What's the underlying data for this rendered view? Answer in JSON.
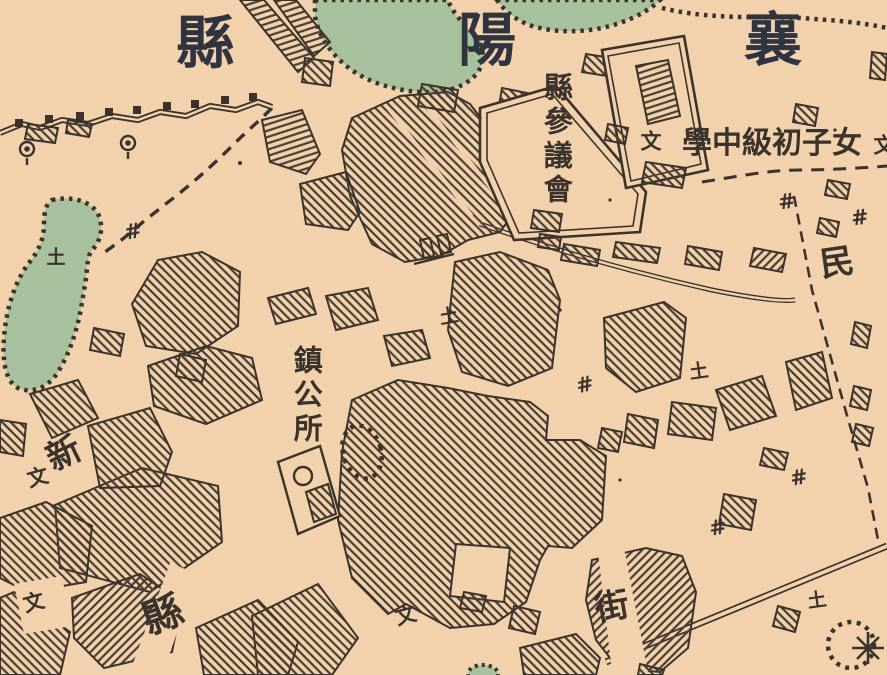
{
  "colors": {
    "paper": "#f1d2ad",
    "water": "#a8c19d",
    "ink": "#3b332b",
    "title_ink": "#2f3440",
    "hatch": "#4a3d33"
  },
  "title": {
    "text": "襄陽縣",
    "note": "map region title, read right-to-left across the top",
    "characters": [
      {
        "char": "襄",
        "x": 773,
        "y": 40,
        "size": 58,
        "rotate": 0
      },
      {
        "char": "陽",
        "x": 487,
        "y": 40,
        "size": 58,
        "rotate": 0
      },
      {
        "char": "縣",
        "x": 205,
        "y": 43,
        "size": 58,
        "rotate": 0
      }
    ]
  },
  "labels": [
    {
      "name": "label-county-council",
      "text": "縣參議會",
      "x": 556,
      "y": 140,
      "size": 29,
      "rotate": 0,
      "vertical": true,
      "direction": "ttb"
    },
    {
      "name": "label-town-hall",
      "text": "鎮公所",
      "x": 306,
      "y": 396,
      "size": 29,
      "rotate": 0,
      "vertical": true,
      "direction": "ttb"
    },
    {
      "name": "label-girls-school",
      "text": "女子初級中學",
      "x": 772,
      "y": 144,
      "size": 30,
      "rotate": 0,
      "vertical": false,
      "direction": "rtl"
    },
    {
      "name": "label-min",
      "text": "民",
      "x": 837,
      "y": 263,
      "size": 34,
      "rotate": -8,
      "vertical": false,
      "direction": "ltr"
    },
    {
      "name": "label-xin",
      "text": "新",
      "x": 64,
      "y": 454,
      "size": 34,
      "rotate": -26,
      "vertical": false,
      "direction": "ltr"
    },
    {
      "name": "label-county-south",
      "text": "縣",
      "x": 163,
      "y": 616,
      "size": 40,
      "rotate": -20,
      "vertical": false,
      "direction": "ltr"
    },
    {
      "name": "label-street",
      "text": "街",
      "x": 612,
      "y": 607,
      "size": 34,
      "rotate": -10,
      "vertical": false,
      "direction": "ltr"
    }
  ],
  "marker_groups": [
    {
      "name": "well-marker",
      "glyph": "#",
      "size": 21,
      "items": [
        {
          "x": 133,
          "y": 232,
          "rotate": -10
        },
        {
          "x": 585,
          "y": 385,
          "rotate": -12
        },
        {
          "x": 787,
          "y": 202,
          "rotate": -8
        },
        {
          "x": 860,
          "y": 218,
          "rotate": -8
        },
        {
          "x": 718,
          "y": 528,
          "rotate": -10
        },
        {
          "x": 799,
          "y": 478,
          "rotate": -10
        }
      ]
    },
    {
      "name": "earth-altar-marker",
      "glyph": "土",
      "size": 19,
      "items": [
        {
          "x": 449,
          "y": 317,
          "rotate": -10
        },
        {
          "x": 699,
          "y": 372,
          "rotate": -8
        },
        {
          "x": 817,
          "y": 601,
          "rotate": -8
        },
        {
          "x": 56,
          "y": 258,
          "rotate": 0
        }
      ]
    },
    {
      "name": "school-symbol-marker",
      "glyph": "文",
      "size": 21,
      "items": [
        {
          "x": 651,
          "y": 142,
          "rotate": 0
        },
        {
          "x": 884,
          "y": 146,
          "rotate": 0
        },
        {
          "x": 38,
          "y": 478,
          "rotate": -15
        },
        {
          "x": 34,
          "y": 603,
          "rotate": -15
        },
        {
          "x": 406,
          "y": 616,
          "rotate": -15
        }
      ]
    }
  ]
}
